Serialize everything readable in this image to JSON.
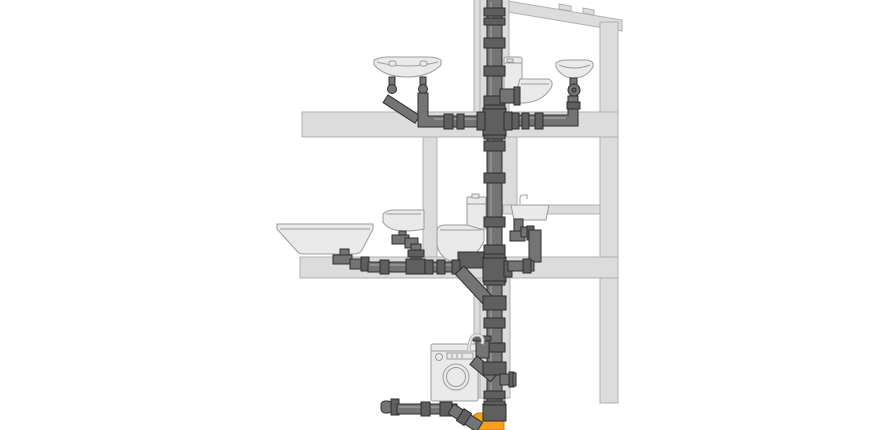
{
  "colors": {
    "background": "#ffffff",
    "structure-fill": "#dcdcdc",
    "structure-stroke": "#b0b0b0",
    "fixture-fill": "#eaeaea",
    "fixture-stroke": "#9c9c9c",
    "pipe-fill": "#747474",
    "pipe-stroke": "#2e2e2e",
    "fitting-fill": "#5f5f5f",
    "pipe-highlight": "#a8a8a8",
    "hose-stroke": "#b5b5b5",
    "sewer-fill": "#f6a01b",
    "sewer-stroke": "#cf7f0a"
  },
  "components": {
    "structure": [
      "sloped-roof",
      "exterior-wall-right",
      "upper-floor-slab",
      "middle-floor-slab",
      "interior-wall",
      "kitchen-counter",
      "service-shaft"
    ],
    "upper_floor_fixtures": [
      "double-washbasin",
      "toilet",
      "small-washbasin"
    ],
    "middle_floor_fixtures": [
      "bathtub",
      "washbasin",
      "toilet",
      "kitchen-sink"
    ],
    "lower_level_fixtures": [
      "washing-machine"
    ],
    "pipework": [
      "vent-soil-stack",
      "upper-branch-drain",
      "middle-branch-drain",
      "washing-machine-standpipe",
      "basement-cleanout-run",
      "sewer-socket"
    ]
  }
}
